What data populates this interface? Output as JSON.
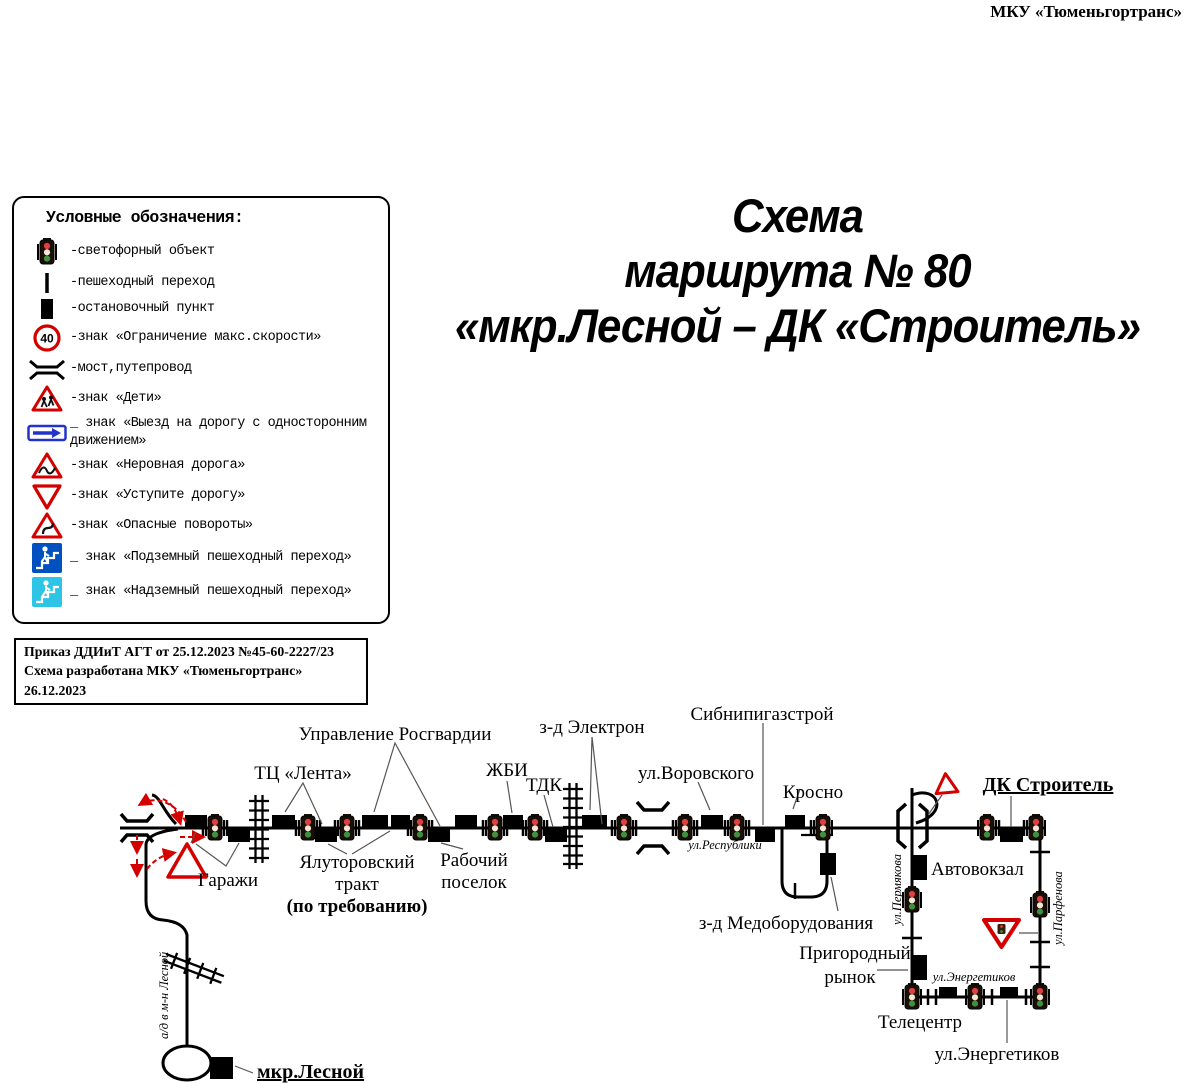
{
  "header": {
    "org": "МКУ «Тюменьгортранс»"
  },
  "title": {
    "line1": "Схема",
    "line2": "маршрута № 80",
    "line3": "«мкр.Лесной – ДК «Строитель»"
  },
  "legend": {
    "title": "Условные обозначения:",
    "items": [
      {
        "icon": "traffic-light-icon",
        "label": "-светофорный объект"
      },
      {
        "icon": "pedestrian-crossing-icon",
        "label": "-пешеходный переход"
      },
      {
        "icon": "bus-stop-icon",
        "label": "-остановочный пункт"
      },
      {
        "icon": "speed-limit-40-icon",
        "label": "-знак «Ограничение макс.скорости»"
      },
      {
        "icon": "bridge-icon",
        "label": "-мост,путепровод"
      },
      {
        "icon": "children-sign-icon",
        "label": "-знак «Дети»"
      },
      {
        "icon": "one-way-road-sign-icon",
        "label": "_ знак «Выезд на дорогу с односторонним движением»"
      },
      {
        "icon": "rough-road-sign-icon",
        "label": "-знак «Неровная дорога»"
      },
      {
        "icon": "give-way-sign-icon",
        "label": "-знак «Уступите дорогу»"
      },
      {
        "icon": "dangerous-turns-sign-icon",
        "label": "-знак «Опасные повороты»"
      },
      {
        "icon": "underground-crossing-sign-icon",
        "label": "_ знак «Подземный пешеходный переход»"
      },
      {
        "icon": "overground-crossing-sign-icon",
        "label": "_ знак «Надземный пешеходный переход»"
      }
    ]
  },
  "order": {
    "line1": "Приказ ДДИиТ АГТ от 25.12.2023 №45-60-2227/23",
    "line2": "Схема разработана МКУ «Тюменьгортранс» 26.12.2023"
  },
  "map": {
    "labels": {
      "upravlenie_rosgvardii": "Управление Росгвардии",
      "tc_lenta": "ТЦ «Лента»",
      "zhbi": "ЖБИ",
      "tdk": "ТДК",
      "zd_elektron": "з-д Электрон",
      "ul_vorovskogo": "ул.Воровского",
      "sibnipigazstroy": "Сибнипигазстрой",
      "krosno": "Кросно",
      "garazhi": "Гаражи",
      "yalutorovskiy_1": "Ялуторовский",
      "yalutorovskiy_2": "тракт",
      "yalutorovskiy_3": "(по требованию)",
      "rabochiy_1": "Рабочий",
      "rabochiy_2": "поселок",
      "ul_respubliki": "ул.Республики",
      "zd_medoborudovaniya": "з-д Медоборудования",
      "prigorodny_1": "Пригородный",
      "prigorodny_2": "рынок",
      "teletsentr": "Телецентр",
      "ul_energetikov_stop": "ул.Энергетиков",
      "ul_energetikov_street": "ул.Энергетиков",
      "ul_permyakova": "ул.Пермякова",
      "ul_parfyonova": "ул.Парфенова",
      "avtovokzal": "Автовокзал",
      "dk_stroitel": "ДК Строитель",
      "mkr_lesnoy": "мкр.Лесной",
      "ad_lesnoy": "а/д в м-н Лесной"
    },
    "colors": {
      "road": "#000000",
      "sign_red": "#d40000",
      "sign_blue": "#2233cc",
      "underpass_blue": "#0050c0",
      "overpass_cyan": "#2ec4e6"
    }
  }
}
